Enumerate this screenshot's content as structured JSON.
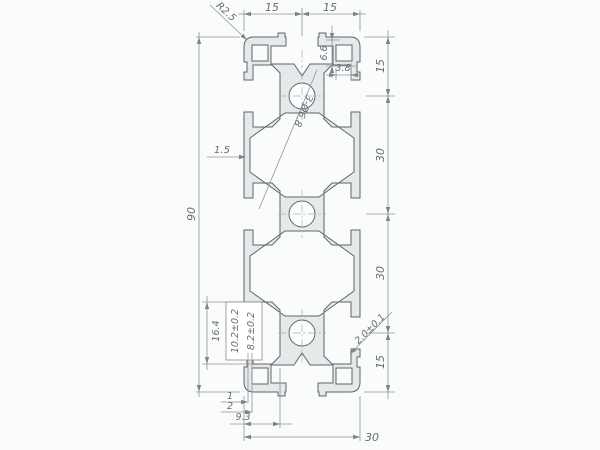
{
  "dimensions": {
    "top_width_left": "15",
    "top_width_right": "15",
    "corner_radius": "R2.5",
    "slot_depth_top_right": "6.6",
    "slot_step_top_right": "3.8",
    "right_segment_top": "15",
    "right_segment_upper_mid": "30",
    "right_segment_lower_mid": "30",
    "right_segment_bottom": "15",
    "overall_height": "90",
    "side_wall_thickness": "1.5",
    "hole_callout": "3-Ø6.8",
    "slot_opening_width": "8.2±0.2",
    "slot_undercut_width": "10.2±0.2",
    "slot_inner_width": "16.4",
    "lip_dim_1": "1",
    "lip_dim_2": "2",
    "slot_depth_bottom_left": "9.3",
    "overall_width": "30",
    "bottom_wall_tolerance": "2.0±0.1"
  },
  "colors": {
    "background": "#fafbfb",
    "metal_fill": "#e8eaec",
    "outline": "#5f666d",
    "dimension_lines": "#8f959b",
    "text": "#686d73",
    "centerline": "#a9aeb4"
  }
}
